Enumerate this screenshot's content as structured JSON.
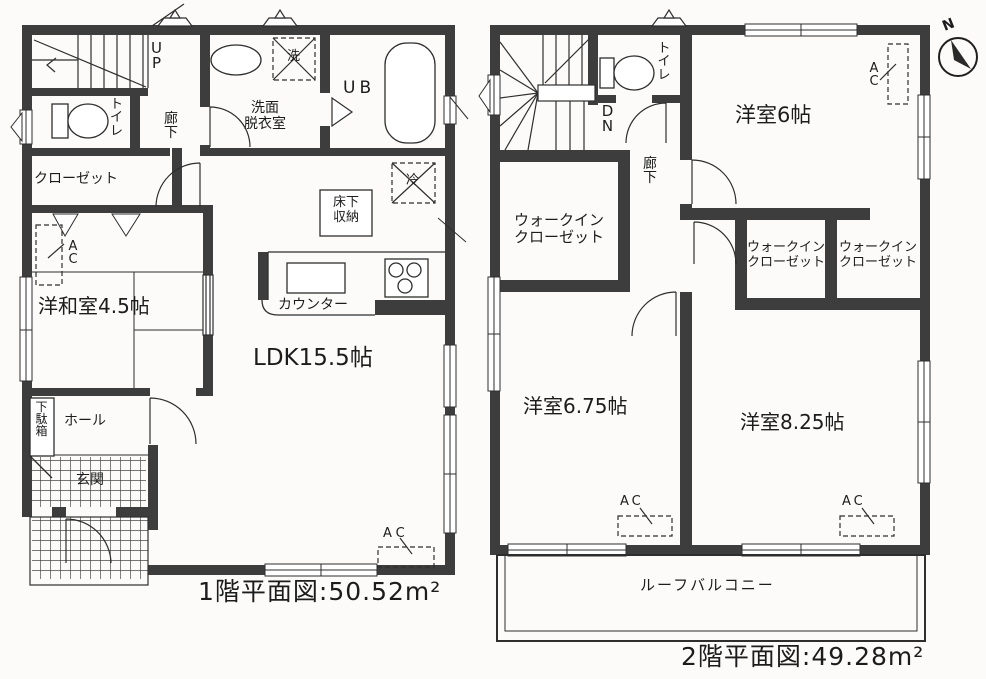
{
  "document": {
    "type": "floor-plan",
    "wall_color": "#3d3d3d",
    "line_color": "#2e2e2e"
  },
  "floor1": {
    "caption": "1階平面図:50.52m²",
    "rooms": {
      "stairs_up": "UP",
      "toilet": "トイレ",
      "corridor": "廊下",
      "closet": "クローゼット",
      "washroom": [
        "洗面",
        "脱衣室"
      ],
      "washer": "洗",
      "bath": "UB",
      "fridge": "冷",
      "floor_storage": [
        "床下",
        "収納"
      ],
      "japanese_room": "洋和室4.5帖",
      "counter": "カウンター",
      "ldk": "LDK15.5帖",
      "shoe_box": "下駄箱",
      "hall": "ホール",
      "entrance": "玄関",
      "ac": "AC"
    }
  },
  "floor2": {
    "caption": "2階平面図:49.28m²",
    "compass_n": "N",
    "rooms": {
      "stairs_down": "DN",
      "toilet": "トイレ",
      "corridor": "廊下",
      "wic": [
        "ウォークイン",
        "クローゼット"
      ],
      "western_6": "洋室6帖",
      "western_675": "洋室6.75帖",
      "western_825": "洋室8.25帖",
      "balcony": "ルーフバルコニー",
      "ac": "AC"
    }
  }
}
